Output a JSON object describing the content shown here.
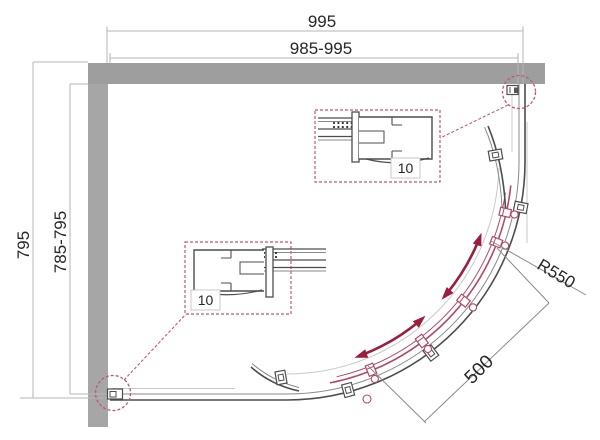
{
  "drawing": {
    "kind": "shower-enclosure-plan",
    "dimensions": {
      "top_overall": "995",
      "top_adjustable": "985-995",
      "left_overall": "795",
      "left_adjustable": "785-795",
      "door_radius": "R550",
      "entry_width": "500"
    },
    "detail_callouts": [
      {
        "label": "10"
      },
      {
        "label": "10"
      }
    ],
    "colors": {
      "wall": "#9e9e9e",
      "wall_side": "#a6a6a6",
      "line_dark": "#4d4d4d",
      "line_medium": "#8a8a8a",
      "line_light": "#c8c8c8",
      "dim_line": "#b5b5b5",
      "text": "#262626",
      "door_red": "#b24863",
      "arrow_red": "#9c1d3c",
      "callout_red": "#c4566e"
    }
  }
}
